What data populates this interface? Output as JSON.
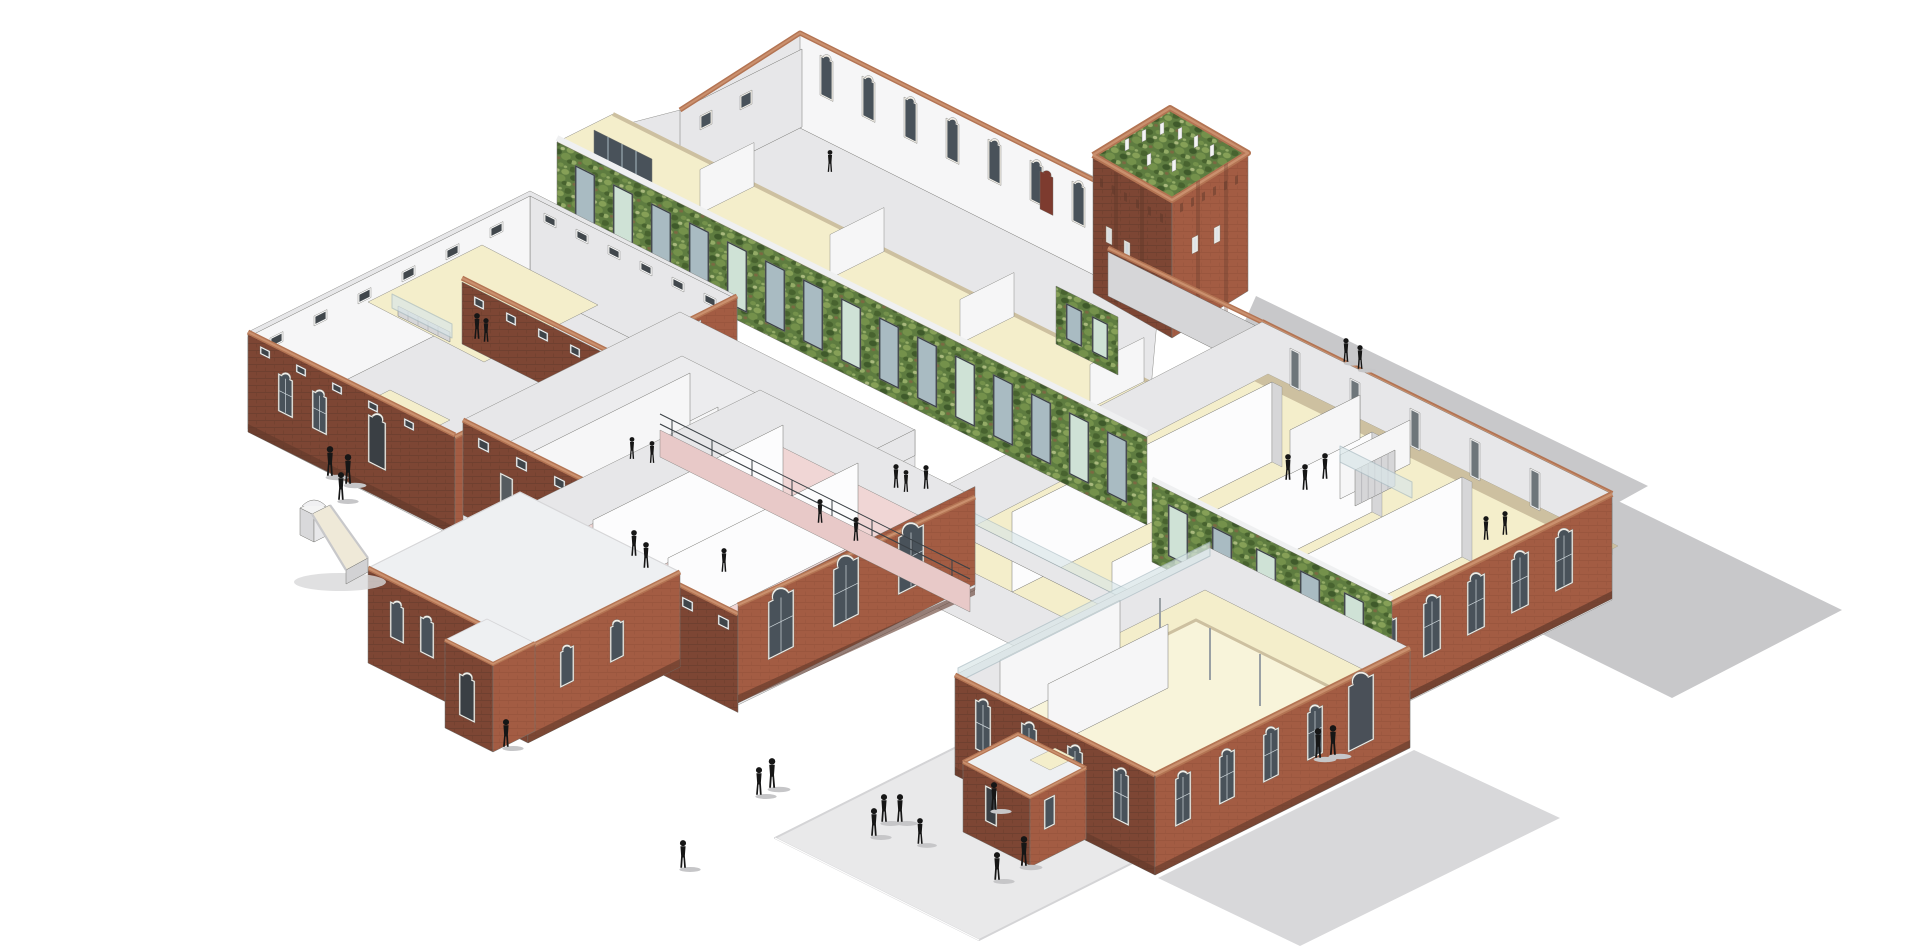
{
  "scene": {
    "type": "architectural-axonometric-cutaway-rendering",
    "description": "Isometric cutaway rendering of a brick school complex: green living-wall gallery spine, brick water tower with planted top, cutaway wings with cream, yellow and pink floors, white upper hall with arched windows, paved plaza, playground slide and silhouette figures",
    "background": "#ffffff",
    "people_count": 36,
    "elements": [
      "cast-shadows",
      "paved-plaza",
      "upper-hall-building",
      "curtain-wall-glazing",
      "water-tower",
      "green-living-wall-gallery",
      "right-classroom-wing",
      "lower-green-wall",
      "left-classroom-wing",
      "courtyard-brick-wall",
      "sanitary-wing",
      "pink-floor-wing",
      "ramp-corridor",
      "gable-roof-building",
      "great-hall-building",
      "entrance-porch",
      "playground-slide",
      "people-figures"
    ]
  },
  "palette": {
    "bg": "#ffffff",
    "shadow": "#c8c8ca",
    "shadowSoft": "#d8d8da",
    "plaza": "#e9e9ea",
    "plazaEdge": "#d4d4d6",
    "wallLit": "#f6f6f7",
    "wallMid": "#e7e7e9",
    "wallShade": "#d6d6d8",
    "wallDark": "#c3c3c7",
    "floorCream": "#f4eecb",
    "floorCreamLight": "#f8f4da",
    "floorTan": "#cdc0a0",
    "floorPink": "#f0d6d5",
    "floorPinkDeep": "#e8c9c8",
    "floorGrey": "#ececee",
    "roofWhite": "#eef0f2",
    "brickLit": "#a35c43",
    "brickMid": "#8f5039",
    "brickShade": "#7d4634",
    "brickDark": "#61392b",
    "copingLit": "#ca906e",
    "coping": "#b37453",
    "copingShade": "#90543a",
    "glassDark": "#49525a",
    "glassPane": "#a9bbc2",
    "glassLight": "#d9e6e8",
    "glassGreen": "#cfe2d6",
    "frameWhite": "#f2efe8",
    "frameDark": "#3a4045",
    "greenBase": "#5e7c40",
    "green1": "#48632f",
    "green2": "#74914b",
    "green3": "#86a057",
    "green4": "#3f5a2b",
    "green5": "#93ab66",
    "green6": "#a9b97d",
    "greenBrown": "#7a6a42",
    "figure": "#161616",
    "figShadow": "#c6c6c8",
    "outline": "#767672",
    "doorRed": "#7d3b2f"
  }
}
